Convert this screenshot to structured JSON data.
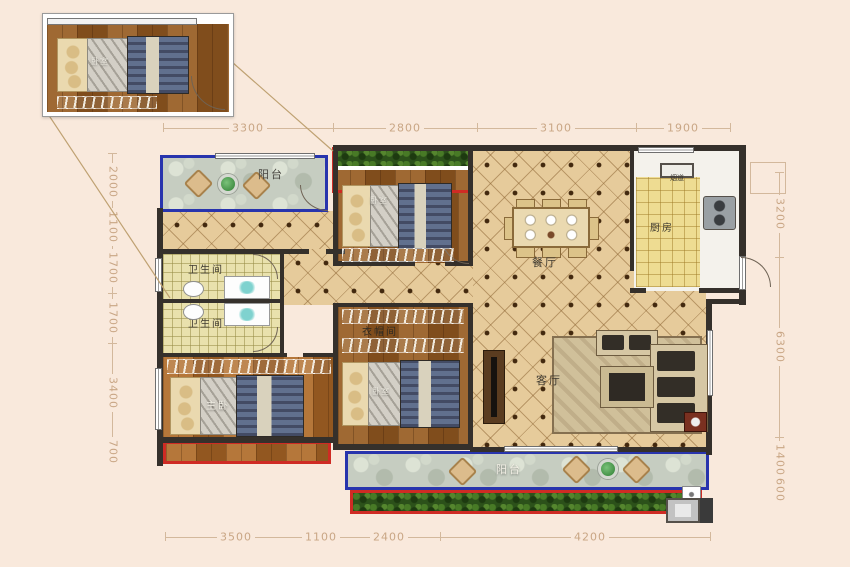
{
  "inset": {
    "room_label": "卧室"
  },
  "rooms": {
    "balcony_top": {
      "label": "阳台"
    },
    "bedroom_top": {
      "label": "卧室"
    },
    "bathroom_upper": {
      "label": "卫生间"
    },
    "bathroom_lower": {
      "label": "卫生间"
    },
    "master_bedroom": {
      "label": "主卧"
    },
    "cloakroom": {
      "label": "衣帽间"
    },
    "bedroom_bottom": {
      "label": "卧室"
    },
    "dining_room": {
      "label": "餐厅"
    },
    "kitchen": {
      "label": "厨房"
    },
    "flue": {
      "label": "烟道"
    },
    "living_room": {
      "label": "客厅"
    },
    "balcony_bottom": {
      "label": "阳台"
    }
  },
  "dimensions": {
    "top": [
      "3300",
      "2800",
      "3100",
      "1900"
    ],
    "bottom": [
      "3500",
      "1100",
      "2400",
      "4200"
    ],
    "left": [
      "2000",
      "1100",
      "1700",
      "1700",
      "3400",
      "700"
    ],
    "right": [
      "3200",
      "6300",
      "1400",
      "600"
    ]
  },
  "colors": {
    "background": "#f9e9dc",
    "wall": "#35302b",
    "balcony_border": "#2834ad",
    "ac_border": "#cf2b24",
    "dimension": "#c9a685"
  }
}
